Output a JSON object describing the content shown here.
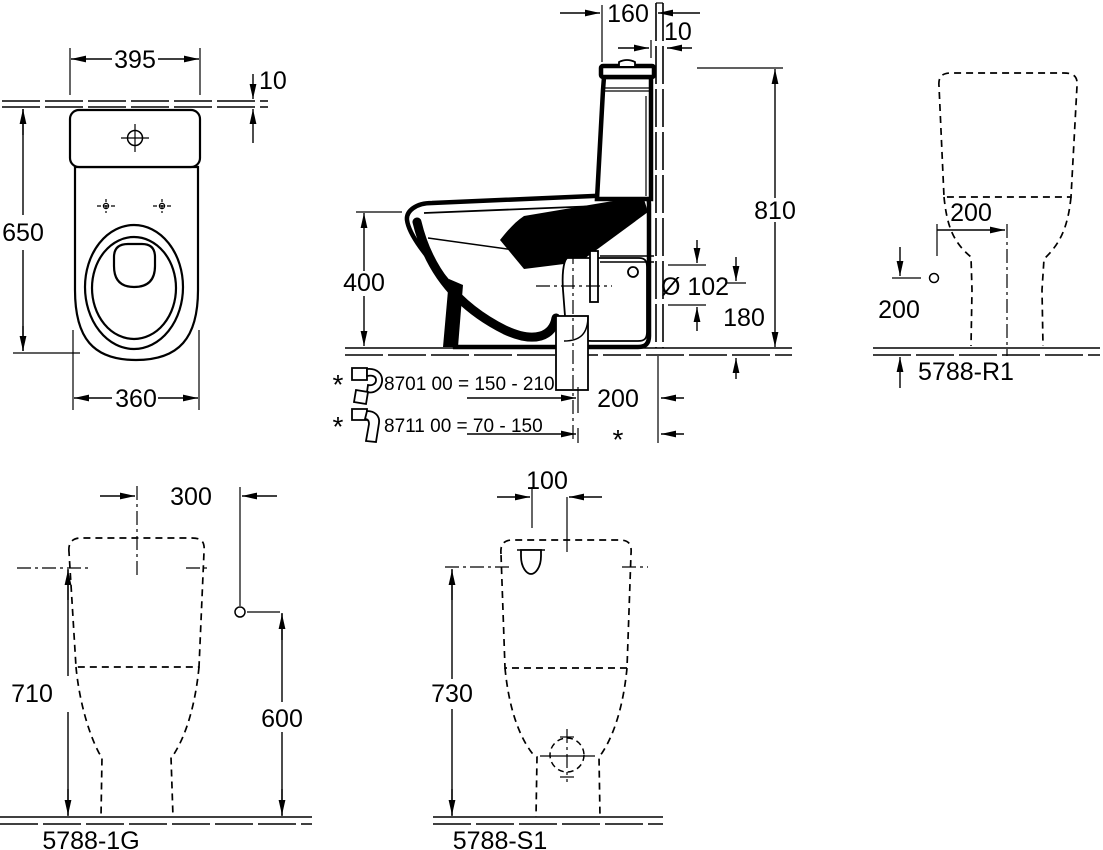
{
  "views": {
    "plan": {
      "dim_seat_width": "395",
      "dim_wall_thickness": "10",
      "dim_depth": "650",
      "dim_bowl_width": "360"
    },
    "side": {
      "dim_cistern_depth": "160",
      "dim_wall_gap": "10",
      "dim_total_height": "810",
      "dim_rim_height": "400",
      "dim_outlet_diameter": "Ø 102",
      "dim_outlet_height": "180",
      "dim_outlet_offset": "200",
      "variable_marker": "*",
      "accessories": [
        {
          "marker": "*",
          "code_range": "8701 00  =  150 - 210"
        },
        {
          "marker": "*",
          "code_range": "8711 00  =  70 -  150"
        }
      ]
    },
    "rear": {
      "label": "5788-R1",
      "dim_supply_offset": "200",
      "dim_supply_height": "200"
    },
    "variant_1g": {
      "label": "5788-1G",
      "dim_supply_offset": "300",
      "dim_height": "710",
      "dim_supply_height": "600"
    },
    "variant_s1": {
      "label": "5788-S1",
      "dim_inlet_offset": "100",
      "dim_height": "730"
    }
  }
}
